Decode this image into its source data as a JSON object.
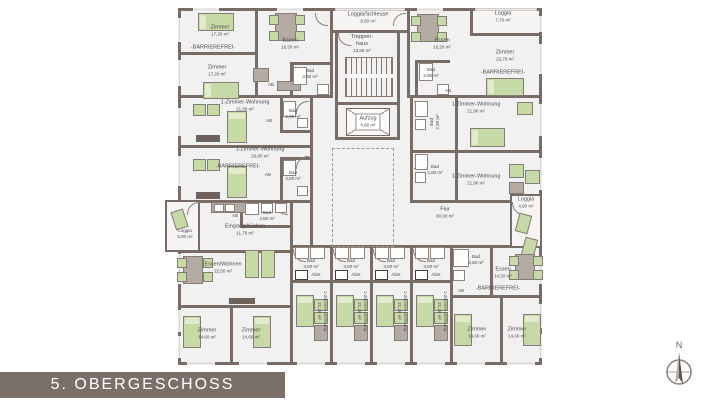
{
  "title": "5. OBERGESCHOSS",
  "compass_n": "N",
  "labels": {
    "ab": "AB",
    "abst": "Abst",
    "barrierefrei": "-BARRIEREFREI-"
  },
  "colors": {
    "wall": "#796b65",
    "furniture_green": "#c7d9a6",
    "title_bar": "#7b6f6a"
  },
  "rooms": {
    "zimmer_tl1": {
      "name": "Zimmer",
      "area": "17,20 m²"
    },
    "zimmer_tl2": {
      "name": "Zimmer",
      "area": "17,20 m²"
    },
    "essen_tl": {
      "name": "Essen",
      "area": "16,50 m²"
    },
    "bad_tl": {
      "name": "Bad",
      "area": "3,80 m²"
    },
    "loggia_schleuse": {
      "name": "Loggia/Schleuse",
      "area": "8,80 m²"
    },
    "treppenhaus": {
      "name": "Treppen-haus",
      "area": "13,80 m²"
    },
    "aufzug": {
      "name": "Aufzug",
      "area": "4,80 m²"
    },
    "essen_tr": {
      "name": "Essen",
      "area": "16,20 m²"
    },
    "loggia_tr": {
      "name": "Loggia",
      "area": "7,70 m²"
    },
    "zimmer_tr": {
      "name": "Zimmer",
      "area": "22,70 m²"
    },
    "bad_tr": {
      "name": "Bad",
      "area": "3,90 m²"
    },
    "wohnung_l1": {
      "name": "1-Zimmer-Wohnung",
      "area": "21,90 m²"
    },
    "bad_l1": {
      "name": "Bad",
      "area": "2,90 m²"
    },
    "wohnung_l2": {
      "name": "1-Zimmer-Wohnung",
      "area": "26,80 m²"
    },
    "bad_l2": {
      "name": "Bad",
      "area": "3,80 m²"
    },
    "wohnung_r1": {
      "name": "1-Zimmer-Wohnung",
      "area": "21,90 m²"
    },
    "bad_r1": {
      "name": "Bad",
      "area": "2,90 m²"
    },
    "wohnung_r2": {
      "name": "1-Zimmer-Wohnung",
      "area": "21,90 m²"
    },
    "bad_r2": {
      "name": "Bad",
      "area": "2,80 m²"
    },
    "loggia_r": {
      "name": "Loggia",
      "area": "4,90 m²"
    },
    "flur": {
      "name": "Flur",
      "area": "80,90 m²"
    },
    "loggia_l": {
      "name": "Loggia",
      "area": "5,80 m²"
    },
    "eingang": {
      "name": "Eingang/Küchen",
      "area": "11,70 m²"
    },
    "bad_eingang": {
      "name": "Bad",
      "area": "4,80 m²"
    },
    "essen_wohnen": {
      "name": "Essen/Wohnen",
      "area": "22,50 m²"
    },
    "zimmer_bl1": {
      "name": "Zimmer",
      "area": "14,60 m²"
    },
    "zimmer_bl2": {
      "name": "Zimmer",
      "area": "14,60 m²"
    },
    "wohnung_v": {
      "name": "1-Zimmer-Wohnung",
      "area": "21,30 m²"
    },
    "bad_v": {
      "name": "Bad",
      "area": "3,90 m²"
    },
    "bad_br": {
      "name": "Bad",
      "area": "3,80 m²"
    },
    "essen_br": {
      "name": "Essen",
      "area": "14,50 m²"
    },
    "zimmer_br1": {
      "name": "Zimmer",
      "area": "14,60 m²"
    },
    "zimmer_br2": {
      "name": "Zimmer",
      "area": "14,60 m²"
    }
  }
}
